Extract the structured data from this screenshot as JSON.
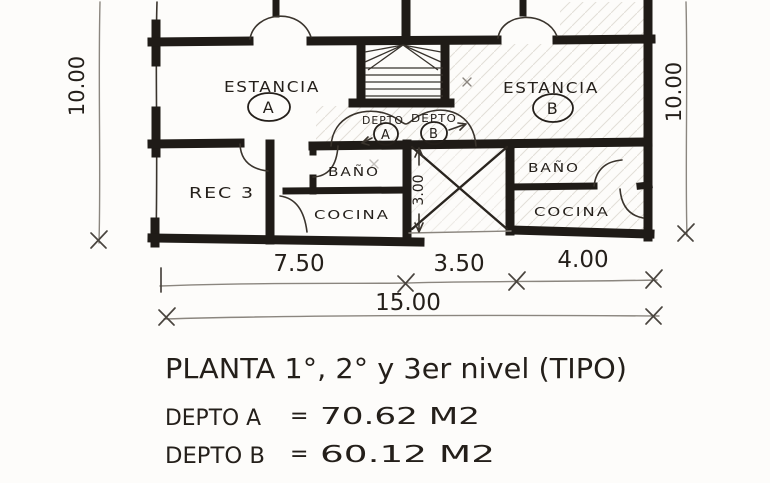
{
  "plan": {
    "room_labels": {
      "estancia_a": {
        "name": "ESTANCIA",
        "tag": "A"
      },
      "estancia_b": {
        "name": "ESTANCIA",
        "tag": "B"
      },
      "rec_3": "REC 3",
      "bano_a": "BAÑO",
      "cocina_a": "COCINA",
      "bano_b": "BAÑO",
      "cocina_b": "COCINA"
    },
    "entrance_labels": {
      "depto_a": {
        "name": "DEPTO",
        "tag": "A"
      },
      "depto_b": {
        "name": "DEPTO",
        "tag": "B"
      }
    },
    "dimensions": {
      "bottom_segments": [
        "7.50",
        "3.50",
        "4.00"
      ],
      "bottom_total": "15.00",
      "left_height": "10.00",
      "right_height": "10.00",
      "shaft_depth": "3.00"
    }
  },
  "notes": {
    "title": "PLANTA 1°, 2° y 3er nivel (TIPO)",
    "areas": [
      {
        "name": "DEPTO A",
        "eq": "=",
        "value": "70.62 M2"
      },
      {
        "name": "DEPTO B",
        "eq": "=",
        "value": "60.12 M2"
      }
    ]
  },
  "colors": {
    "ink": "#241f1a",
    "pencil": "#8b867f",
    "paper": "#fdfcfa",
    "hatch": "#ccc6bc"
  }
}
